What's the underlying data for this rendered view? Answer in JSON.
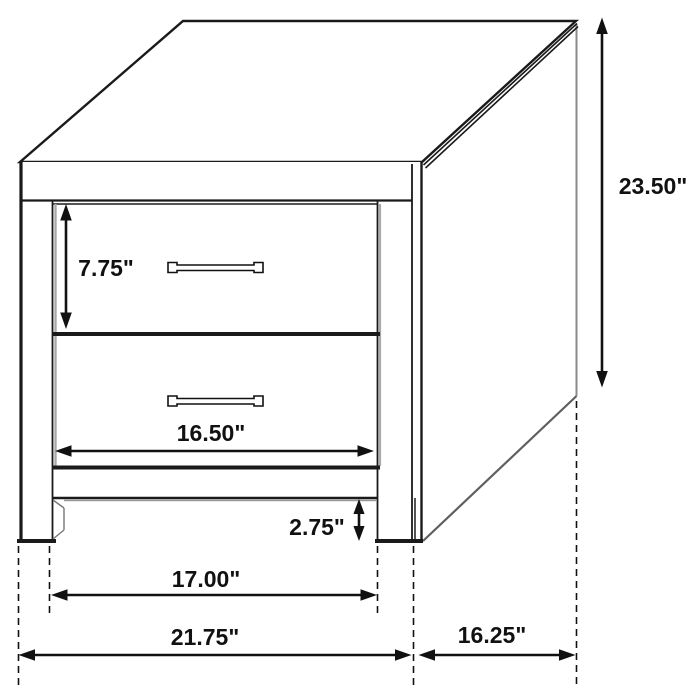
{
  "diagram": {
    "title": "Two-drawer nightstand dimension diagram",
    "subject": "nightstand line drawing with measurements",
    "units": "inches",
    "colors": {
      "line": "#1a1a1a",
      "background": "#ffffff",
      "shadow_gray": "#9a9a9a"
    },
    "dimensions": {
      "overall_height": "23.50\"",
      "drawer_opening_height": "7.75\"",
      "drawer_width": "16.50\"",
      "leg_height": "2.75\"",
      "inner_width": "17.00\"",
      "overall_width": "21.75\"",
      "depth": "16.25\""
    }
  }
}
